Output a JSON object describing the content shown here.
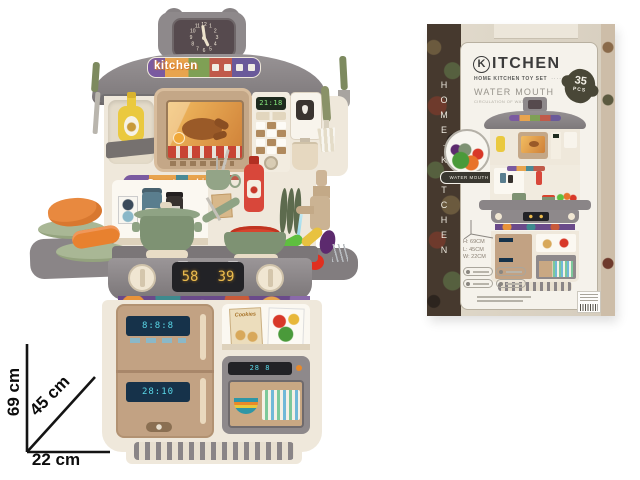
{
  "toy": {
    "banner_label": "kitchen",
    "smart_label": "Smart cooking",
    "clock_numbers": [
      "12",
      "1",
      "2",
      "3",
      "4",
      "5",
      "6",
      "7",
      "8",
      "9",
      "10",
      "11"
    ],
    "control_display": "21:18",
    "stove_display_left": "58",
    "stove_display_right": "39",
    "fridge_display_top": "8:8:8",
    "fridge_display_bottom": "28:10",
    "dishwasher_display": "28 8",
    "cookies_label": "Cookies"
  },
  "annotation": {
    "height_label": "69 cm",
    "diagonal_label": "45 cm",
    "width_label": "22 cm"
  },
  "box": {
    "title_initial": "K",
    "title_rest": "ITCHEN",
    "subtitle": "HOME KITCHEN TOY SET",
    "subtitle_dots": "·········",
    "feature_title": "WATER MOUTH",
    "feature_subtitle": "CIRCULATION OF WATER",
    "pcs_count": "35",
    "pcs_unit": "PCS",
    "water_badge_label": "WATER MOUTH",
    "size_h": "H: 69CM",
    "size_l": "L: 45CM",
    "size_w": "W: 22CM",
    "side_text": "HOME·KITCHEN"
  },
  "colors": {
    "hood_gray": "#8e898b",
    "body_cream": "#efe8db",
    "wood_tan": "#c2a283",
    "pot_green": "#7e9273",
    "ketchup_red": "#d8473a",
    "display_amber": "#ecbc4e",
    "display_green": "#86e87c",
    "display_cyan": "#5ad8e8",
    "banner_purple": "#7a5aa0",
    "banner_orange": "#e8a44e",
    "box_cream": "#ddd5c7",
    "camo_brown": "#46392e"
  }
}
